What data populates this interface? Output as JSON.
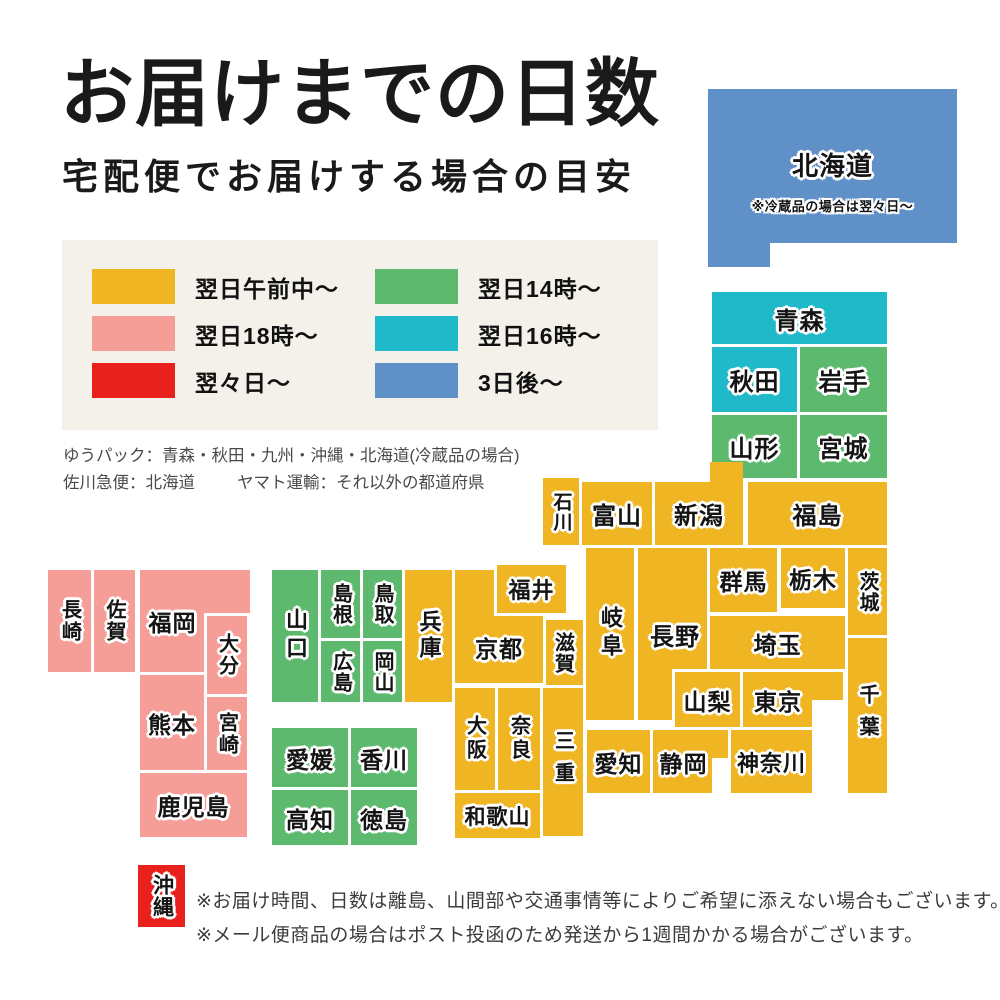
{
  "palette": {
    "page_bg": "#ffffff",
    "panel_bg": "#f3f1e9",
    "next_morning": "#efb522",
    "next_18": "#f59e97",
    "two_days": "#e8211d",
    "next_14": "#5cb96d",
    "next_16": "#1fb9c9",
    "three_days": "#5f90c8"
  },
  "header": {
    "title": "お届けまでの日数",
    "subtitle": "宅配便でお届けする場合の目安"
  },
  "legend": {
    "items": [
      {
        "label": "翌日午前中〜",
        "color": "next_morning"
      },
      {
        "label": "翌日14時〜",
        "color": "next_14"
      },
      {
        "label": "翌日18時〜",
        "color": "next_18"
      },
      {
        "label": "翌日16時〜",
        "color": "next_16"
      },
      {
        "label": "翌々日〜",
        "color": "two_days"
      },
      {
        "label": "3日後〜",
        "color": "three_days"
      }
    ]
  },
  "carriers": {
    "line1": "ゆうパック：青森・秋田・九州・沖縄・北海道(冷蔵品の場合)",
    "line2a": "佐川急便：北海道",
    "line2b": "ヤマト運輸：それ以外の都道府県"
  },
  "map": {
    "blocks": [
      {
        "id": "hokkaido",
        "label": "北海道",
        "note": "※冷蔵品の場合は翌々日〜",
        "color": "three_days",
        "x": 708,
        "y": 89,
        "w": 249,
        "h": 154,
        "fs": 26,
        "pt": 28
      },
      {
        "id": "hokkaido-tab",
        "label": "",
        "color": "three_days",
        "x": 708,
        "y": 243,
        "w": 62,
        "h": 24,
        "patch": true
      },
      {
        "id": "aomori",
        "label": "青森",
        "color": "next_16",
        "x": 712,
        "y": 292,
        "w": 175,
        "h": 53,
        "fs": 24
      },
      {
        "id": "akita",
        "label": "秋田",
        "color": "next_16",
        "x": 712,
        "y": 347,
        "w": 85,
        "h": 65,
        "fs": 24
      },
      {
        "id": "iwate",
        "label": "岩手",
        "color": "next_14",
        "x": 800,
        "y": 347,
        "w": 87,
        "h": 65,
        "fs": 24
      },
      {
        "id": "yamagata",
        "label": "山形",
        "color": "next_14",
        "x": 712,
        "y": 415,
        "w": 85,
        "h": 63,
        "fs": 24
      },
      {
        "id": "miyagi",
        "label": "宮城",
        "color": "next_14",
        "x": 800,
        "y": 415,
        "w": 87,
        "h": 63,
        "fs": 24
      },
      {
        "id": "niigata",
        "label": "新潟",
        "color": "next_morning",
        "x": 655,
        "y": 482,
        "w": 88,
        "h": 63,
        "fs": 24
      },
      {
        "id": "niigata-tab",
        "label": "",
        "color": "next_morning",
        "x": 710,
        "y": 462,
        "w": 33,
        "h": 21,
        "patch": true
      },
      {
        "id": "fukushima",
        "label": "福島",
        "color": "next_morning",
        "x": 748,
        "y": 482,
        "w": 139,
        "h": 63,
        "fs": 24
      },
      {
        "id": "ishikawa",
        "label": "石川",
        "color": "next_morning",
        "x": 543,
        "y": 478,
        "w": 36,
        "h": 67,
        "v": true,
        "fs": 19
      },
      {
        "id": "toyama",
        "label": "富山",
        "color": "next_morning",
        "x": 582,
        "y": 482,
        "w": 70,
        "h": 63,
        "fs": 24
      },
      {
        "id": "gifu",
        "label": "岐阜",
        "color": "next_morning",
        "x": 586,
        "y": 548,
        "w": 48,
        "h": 172,
        "v": true,
        "fs": 22,
        "ls": 6
      },
      {
        "id": "nagano",
        "label": "長野",
        "color": "next_morning",
        "x": 638,
        "y": 548,
        "w": 74,
        "h": 172,
        "fs": 24
      },
      {
        "id": "gunma",
        "label": "群馬",
        "color": "next_morning",
        "x": 710,
        "y": 548,
        "w": 67,
        "h": 64,
        "fs": 23
      },
      {
        "id": "tochigi",
        "label": "栃木",
        "color": "next_morning",
        "x": 781,
        "y": 548,
        "w": 64,
        "h": 60,
        "fs": 23
      },
      {
        "id": "ibaraki",
        "label": "茨城",
        "color": "next_morning",
        "x": 848,
        "y": 548,
        "w": 39,
        "h": 87,
        "v": true,
        "fs": 20
      },
      {
        "id": "saitama",
        "label": "埼玉",
        "color": "next_morning",
        "x": 710,
        "y": 616,
        "w": 135,
        "h": 54,
        "fs": 23
      },
      {
        "id": "chiba",
        "label": "千葉",
        "color": "next_morning",
        "x": 848,
        "y": 638,
        "w": 39,
        "h": 155,
        "v": true,
        "fs": 20,
        "ls": 12
      },
      {
        "id": "yamanashi",
        "label": "山梨",
        "color": "next_morning",
        "x": 675,
        "y": 672,
        "w": 65,
        "h": 55,
        "fs": 23
      },
      {
        "id": "tokyo",
        "label": "東京",
        "color": "next_morning",
        "x": 743,
        "y": 672,
        "w": 100,
        "h": 55,
        "fs": 23,
        "pr": 30
      },
      {
        "id": "tokyo-bay",
        "label": "",
        "color": "bg",
        "x": 812,
        "y": 700,
        "w": 32,
        "h": 28,
        "patch": true
      },
      {
        "id": "shizuoka",
        "label": "静岡",
        "color": "next_morning",
        "x": 653,
        "y": 730,
        "w": 77,
        "h": 63,
        "fs": 23,
        "pr": 16
      },
      {
        "id": "suruga-bay",
        "label": "",
        "color": "bg",
        "x": 712,
        "y": 758,
        "w": 18,
        "h": 36,
        "patch": true
      },
      {
        "id": "kanagawa",
        "label": "神奈川",
        "color": "next_morning",
        "x": 731,
        "y": 730,
        "w": 81,
        "h": 63,
        "fs": 22
      },
      {
        "id": "aichi",
        "label": "愛知",
        "color": "next_morning",
        "x": 587,
        "y": 730,
        "w": 63,
        "h": 63,
        "fs": 23
      },
      {
        "id": "mie",
        "label": "三重",
        "color": "next_morning",
        "x": 543,
        "y": 688,
        "w": 40,
        "h": 148,
        "v": true,
        "fs": 20,
        "ls": 12
      },
      {
        "id": "shiga",
        "label": "滋賀",
        "color": "next_morning",
        "x": 543,
        "y": 620,
        "w": 40,
        "h": 65,
        "v": true,
        "fs": 20
      },
      {
        "id": "kyoto",
        "label": "京都",
        "color": "next_morning",
        "x": 455,
        "y": 570,
        "w": 88,
        "h": 113,
        "fs": 23,
        "pt": 40
      },
      {
        "id": "fukui",
        "label": "福井",
        "color": "next_morning",
        "x": 497,
        "y": 565,
        "w": 69,
        "h": 48,
        "fs": 22
      },
      {
        "id": "hyogo",
        "label": "兵庫",
        "color": "next_morning",
        "x": 405,
        "y": 570,
        "w": 47,
        "h": 132,
        "v": true,
        "fs": 22,
        "ls": 4
      },
      {
        "id": "osaka",
        "label": "大阪",
        "color": "next_morning",
        "x": 455,
        "y": 688,
        "w": 40,
        "h": 102,
        "v": true,
        "fs": 20,
        "ls": 4
      },
      {
        "id": "nara",
        "label": "奈良",
        "color": "next_morning",
        "x": 498,
        "y": 688,
        "w": 42,
        "h": 102,
        "v": true,
        "fs": 20,
        "ls": 4
      },
      {
        "id": "wakayama",
        "label": "和歌山",
        "color": "next_morning",
        "x": 455,
        "y": 793,
        "w": 85,
        "h": 45,
        "fs": 21
      },
      {
        "id": "yamaguchi",
        "label": "山口",
        "color": "next_14",
        "x": 272,
        "y": 570,
        "w": 46,
        "h": 132,
        "v": true,
        "fs": 22,
        "ls": 6
      },
      {
        "id": "shimane",
        "label": "島根",
        "color": "next_14",
        "x": 321,
        "y": 570,
        "w": 40,
        "h": 68,
        "v": true,
        "fs": 20
      },
      {
        "id": "tottori",
        "label": "鳥取",
        "color": "next_14",
        "x": 363,
        "y": 570,
        "w": 39,
        "h": 68,
        "v": true,
        "fs": 20
      },
      {
        "id": "hiroshima",
        "label": "広島",
        "color": "next_14",
        "x": 321,
        "y": 641,
        "w": 40,
        "h": 61,
        "v": true,
        "fs": 20
      },
      {
        "id": "okayama",
        "label": "岡山",
        "color": "next_14",
        "x": 363,
        "y": 641,
        "w": 39,
        "h": 61,
        "v": true,
        "fs": 20
      },
      {
        "id": "ehime",
        "label": "愛媛",
        "color": "next_14",
        "x": 272,
        "y": 728,
        "w": 76,
        "h": 59,
        "fs": 23
      },
      {
        "id": "kagawa",
        "label": "香川",
        "color": "next_14",
        "x": 351,
        "y": 728,
        "w": 66,
        "h": 59,
        "fs": 23
      },
      {
        "id": "kochi",
        "label": "高知",
        "color": "next_14",
        "x": 272,
        "y": 790,
        "w": 76,
        "h": 55,
        "fs": 23
      },
      {
        "id": "tokushima",
        "label": "徳島",
        "color": "next_14",
        "x": 351,
        "y": 790,
        "w": 66,
        "h": 55,
        "fs": 23
      },
      {
        "id": "nagasaki",
        "label": "長崎",
        "color": "next_18",
        "x": 48,
        "y": 570,
        "w": 44,
        "h": 102,
        "v": true,
        "fs": 20,
        "ls": 2
      },
      {
        "id": "saga",
        "label": "佐賀",
        "color": "next_18",
        "x": 94,
        "y": 570,
        "w": 41,
        "h": 102,
        "v": true,
        "fs": 20,
        "ls": 2
      },
      {
        "id": "fukuoka",
        "label": "福岡",
        "color": "next_18",
        "x": 140,
        "y": 570,
        "w": 110,
        "h": 102,
        "fs": 23,
        "pr": 45
      },
      {
        "id": "kumamoto",
        "label": "熊本",
        "color": "next_18",
        "x": 140,
        "y": 675,
        "w": 64,
        "h": 95,
        "fs": 23
      },
      {
        "id": "oita",
        "label": "大分",
        "color": "next_18",
        "x": 207,
        "y": 616,
        "w": 40,
        "h": 78,
        "v": true,
        "fs": 20,
        "ls": 2
      },
      {
        "id": "miyazaki",
        "label": "宮崎",
        "color": "next_18",
        "x": 207,
        "y": 697,
        "w": 40,
        "h": 73,
        "v": true,
        "fs": 20,
        "ls": 2
      },
      {
        "id": "kagoshima",
        "label": "鹿児島",
        "color": "next_18",
        "x": 140,
        "y": 773,
        "w": 107,
        "h": 64,
        "fs": 23
      },
      {
        "id": "okinawa",
        "label": "沖縄",
        "color": "two_days",
        "x": 138,
        "y": 865,
        "w": 47,
        "h": 62,
        "v": true,
        "fs": 21
      }
    ]
  },
  "footer": {
    "note1": "※お届け時間、日数は離島、山間部や交通事情等によりご希望に添えない場合もございます。",
    "note2": "※メール便商品の場合はポスト投函のため発送から1週間かかる場合がございます。"
  }
}
